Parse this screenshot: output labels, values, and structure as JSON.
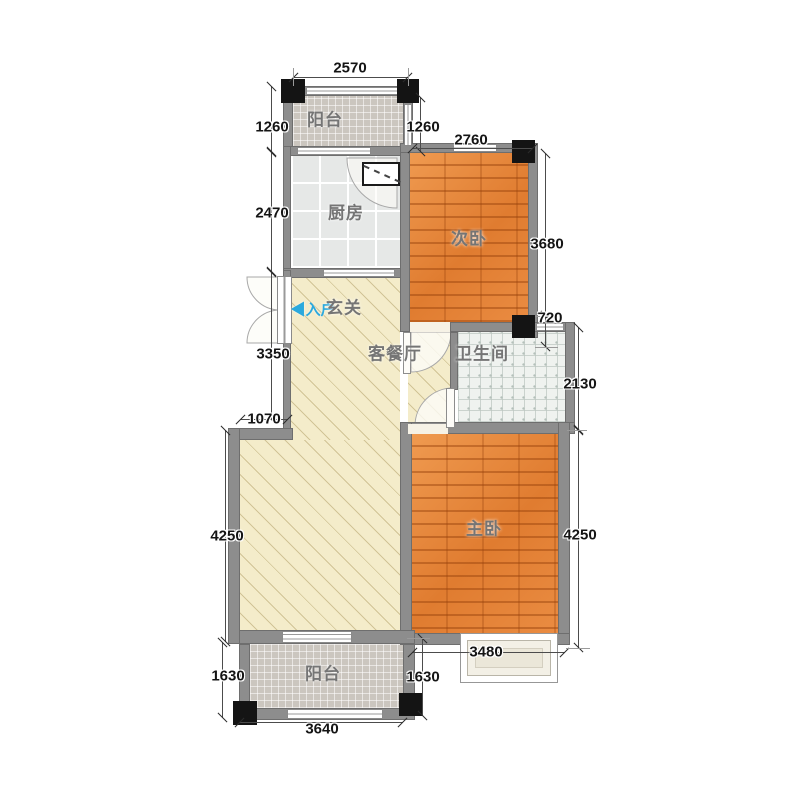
{
  "rooms": {
    "balcony_top": {
      "label": "阳台"
    },
    "kitchen": {
      "label": "厨房"
    },
    "bedroom_second": {
      "label": "次卧"
    },
    "entry": {
      "label": "玄关",
      "arrow": "◀",
      "direction_label": "入户"
    },
    "living_dining": {
      "label": "客餐厅"
    },
    "bathroom": {
      "label": "卫生间"
    },
    "bedroom_master": {
      "label": "主卧"
    },
    "balcony_bottom": {
      "label": "阳台"
    }
  },
  "dimensions_mm": {
    "top_width": "2570",
    "balcony_top_left_height": "1260",
    "balcony_top_right_height": "1260",
    "bedroom_second_width": "2760",
    "kitchen_height": "2470",
    "bedroom_second_height": "3680",
    "pier_height": "720",
    "bathroom_height": "2130",
    "entry_wall_height": "3350",
    "jog_width": "1070",
    "living_height": "4250",
    "master_height": "4250",
    "bay_window_width": "3480",
    "balcony_bottom_left_height": "1630",
    "balcony_bottom_right_height": "1630",
    "balcony_bottom_width": "3640"
  },
  "colors": {
    "wall": "#8d8d8d",
    "column": "#141414",
    "wood_floor": "#e5853c",
    "living_floor": "#f4ecca",
    "kitchen_tile": "#e6e8e7",
    "bathroom_tile": "#eff2ef",
    "balcony_tile": "#cbc6bf",
    "entry_arrow_blue": "#2ba9dd",
    "dimension_text": "#141414",
    "room_label_text": "#757575"
  }
}
